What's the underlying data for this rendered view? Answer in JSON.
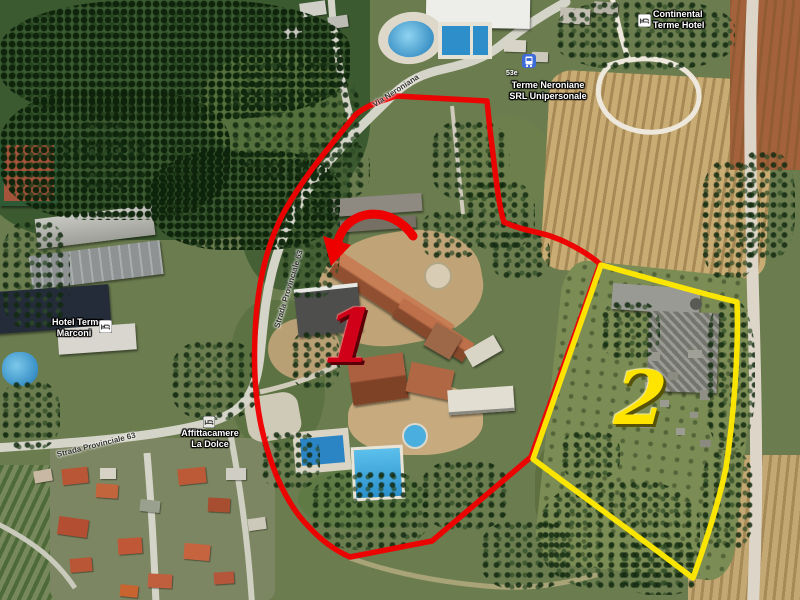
{
  "annotations": {
    "area1_number": "1",
    "area2_number": "2"
  },
  "poi": {
    "terme_neroniane": {
      "line1": "Terme Neroniane",
      "line2": "SRL Unipersonale",
      "stop_code": "53e"
    },
    "continental": {
      "line1": "Continental",
      "line2": "Terme Hotel"
    },
    "marconi": {
      "line1": "Hotel Terme",
      "line2": "Marconi"
    },
    "affittacamere": {
      "line1": "Affittacamere",
      "line2": "La Dolce"
    }
  },
  "roads": {
    "via_neroniana": "Via Neroniana",
    "sp_west": "Strada Provinciale 63",
    "sp_south": "Strada Provinciale 63"
  },
  "colors": {
    "area1_outline": "#ee0000",
    "area2_outline": "#ffe800",
    "area1_number": "#d10019",
    "area2_number": "#ffe400",
    "bus_icon": "#3f6bd8"
  }
}
